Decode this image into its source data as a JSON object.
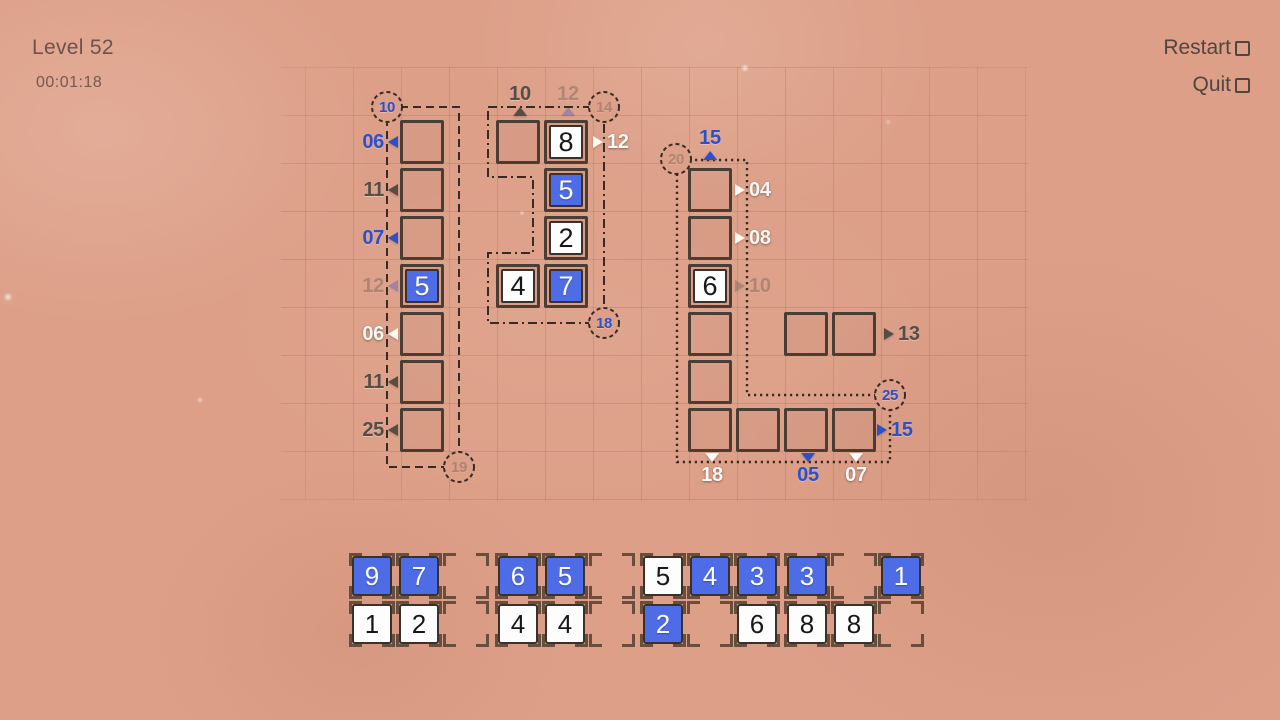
{
  "header": {
    "level_label": "Level 52",
    "timer": "00:01:18",
    "restart_label": "Restart",
    "quit_label": "Quit"
  },
  "colors": {
    "background": "#dd9f88",
    "tile_blue": "#4d6ce5",
    "tile_white": "#fdfdfd",
    "clue_blue": "#2b50cc",
    "clue_gray": "#564e46",
    "clue_white": "#fcf9f6",
    "region_border": "#362c25",
    "cell_border": "#4a3e34",
    "slot_bracket": "#6a4e3d"
  },
  "board": {
    "left_region": {
      "border_style": "dashed",
      "circle_top": {
        "value": "10",
        "style": "blue"
      },
      "circle_bottom": {
        "value": "19",
        "style": "faded"
      },
      "row_clues": [
        {
          "value": "06",
          "style": "blue"
        },
        {
          "value": "11",
          "style": "gray"
        },
        {
          "value": "07",
          "style": "blue"
        },
        {
          "value": "12",
          "style": "faded"
        },
        {
          "value": "06",
          "style": "white"
        },
        {
          "value": "11",
          "style": "gray"
        },
        {
          "value": "25",
          "style": "gray"
        }
      ],
      "cells": [
        {
          "tile": null
        },
        {
          "tile": null
        },
        {
          "tile": null
        },
        {
          "tile": {
            "value": "5",
            "color": "blue"
          }
        },
        {
          "tile": null
        },
        {
          "tile": null
        },
        {
          "tile": null
        }
      ]
    },
    "middle_region": {
      "border_style": "dash-dot",
      "circle_top_right": {
        "value": "14",
        "style": "faded"
      },
      "circle_bottom_right": {
        "value": "18",
        "style": "blue"
      },
      "col_clues_top": [
        {
          "value": "10",
          "style": "gray"
        },
        {
          "value": "12",
          "style": "faded-blue"
        }
      ],
      "row_clue_right": {
        "value": "12",
        "style": "white"
      },
      "cells": [
        {
          "tile": null
        },
        {
          "tile": {
            "value": "8",
            "color": "white"
          }
        },
        {
          "tile": {
            "value": "5",
            "color": "blue"
          }
        },
        {
          "tile": {
            "value": "2",
            "color": "white"
          }
        },
        {
          "tile": {
            "value": "4",
            "color": "white"
          }
        },
        {
          "tile": {
            "value": "7",
            "color": "blue"
          }
        }
      ]
    },
    "right_region": {
      "border_style": "dotted",
      "circle_top_left": {
        "value": "20",
        "style": "faded"
      },
      "circle_corner": {
        "value": "25",
        "style": "blue"
      },
      "col_clue_top": {
        "value": "15",
        "style": "blue"
      },
      "row_clues_right": [
        {
          "value": "04",
          "style": "white"
        },
        {
          "value": "08",
          "style": "white"
        },
        {
          "value": "10",
          "style": "faded"
        }
      ],
      "bottom_row_clue_right": {
        "value": "15",
        "style": "blue"
      },
      "bottom_clues": [
        {
          "value": "18",
          "style": "white"
        },
        {
          "value": "05",
          "style": "blue"
        },
        {
          "value": "07",
          "style": "white"
        }
      ],
      "cells": [
        {
          "tile": null
        },
        {
          "tile": null
        },
        {
          "tile": {
            "value": "6",
            "color": "white"
          }
        },
        {
          "tile": null
        },
        {
          "tile": null
        },
        {
          "tile": null
        },
        {
          "tile": null
        },
        {
          "tile": null
        },
        {
          "tile": null
        }
      ]
    },
    "free_pair": {
      "row_clue_right": {
        "value": "13",
        "style": "gray"
      },
      "cells": [
        {
          "tile": null
        },
        {
          "tile": null
        }
      ]
    }
  },
  "tray": {
    "groups": [
      {
        "top": [
          {
            "value": "9",
            "color": "blue"
          },
          {
            "value": "7",
            "color": "blue"
          },
          null
        ],
        "bottom": [
          {
            "value": "1",
            "color": "white"
          },
          {
            "value": "2",
            "color": "white"
          },
          null
        ]
      },
      {
        "top": [
          {
            "value": "6",
            "color": "blue"
          },
          {
            "value": "5",
            "color": "blue"
          },
          null
        ],
        "bottom": [
          {
            "value": "4",
            "color": "white"
          },
          {
            "value": "4",
            "color": "white"
          },
          null
        ]
      },
      {
        "top": [
          {
            "value": "5",
            "color": "white"
          },
          {
            "value": "4",
            "color": "blue"
          },
          {
            "value": "3",
            "color": "blue"
          }
        ],
        "bottom": [
          {
            "value": "2",
            "color": "blue"
          },
          null,
          {
            "value": "6",
            "color": "white"
          }
        ]
      },
      {
        "top": [
          {
            "value": "3",
            "color": "blue"
          },
          null,
          {
            "value": "1",
            "color": "blue"
          }
        ],
        "bottom": [
          {
            "value": "8",
            "color": "white"
          },
          {
            "value": "8",
            "color": "white"
          },
          null
        ]
      }
    ]
  }
}
